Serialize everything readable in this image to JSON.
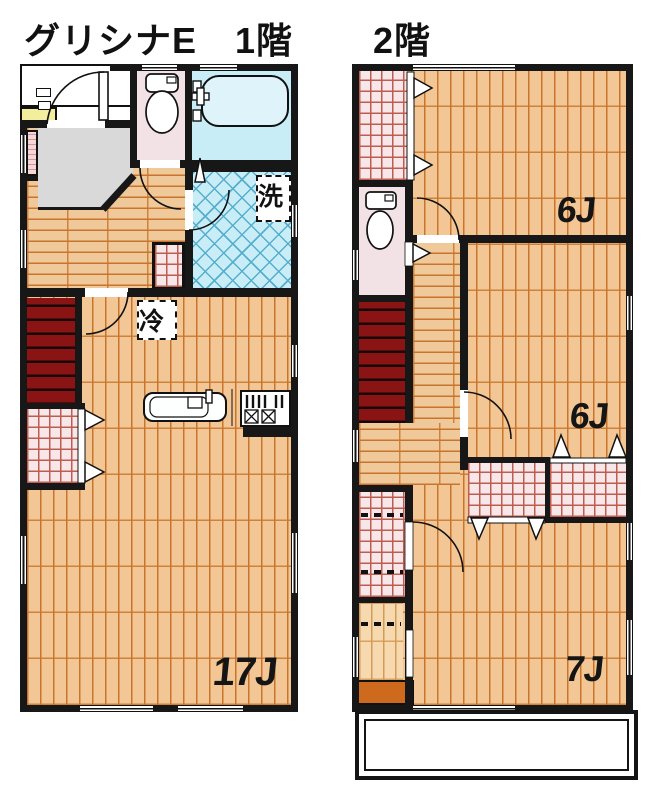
{
  "header": {
    "building": "グリシナE",
    "floor1": "1階",
    "floor2": "2階"
  },
  "floor1": {
    "rooms": {
      "ldk": "17J",
      "laundry": "洗",
      "fridge": "冷"
    }
  },
  "floor2": {
    "rooms": {
      "bedroom_top": "6J",
      "bedroom_mid": "6J",
      "bedroom_bottom": "7J"
    }
  },
  "colors": {
    "wall": "#171717",
    "floor_wood": "#f3c795",
    "wood_line": "#c8742c",
    "hall_wood": "#f0c99b",
    "closet_bg": "#f7e7e9",
    "closet_line": "#bf5c52",
    "stairs_red": "#8a1414",
    "bath_blue": "#c9edf7",
    "tile_line": "#56aecd",
    "toilet_pink": "#f2e2e6",
    "entry_gray": "#d9d9d9",
    "vanity_yellow": "#f2ee9e",
    "storage_orange": "#cd6a1e"
  }
}
